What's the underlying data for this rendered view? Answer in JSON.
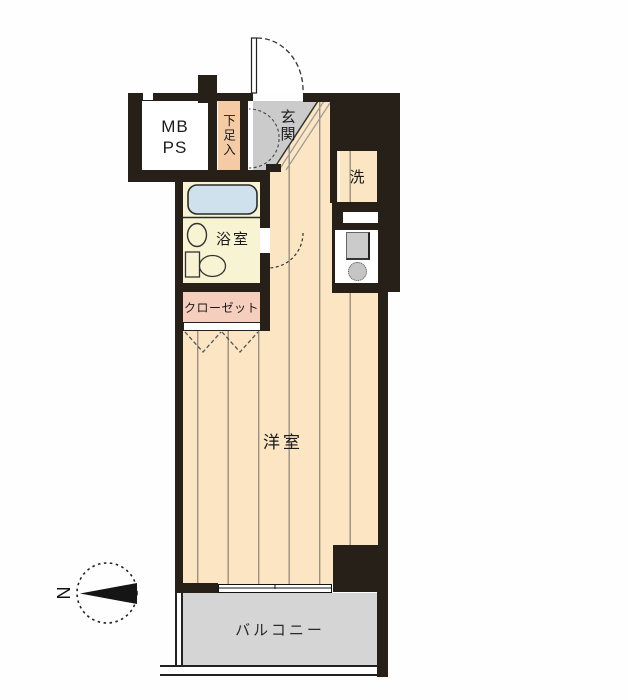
{
  "title": "apartment-floor-plan",
  "rooms": {
    "meter_pipe_space": "MB\nPS",
    "shoe_cabinet": "下足入",
    "entrance": "玄関",
    "laundry": "洗",
    "bathroom": "浴室",
    "closet": "クローゼット",
    "western_room": "洋室",
    "balcony": "バルコニー"
  },
  "compass": {
    "north": "N"
  },
  "colors": {
    "wall": "#272019",
    "flooring": "#fbe5c2",
    "flooring_line": "#9b9083",
    "bathroom": "#f8f4d3",
    "bathtub": "#cfe1ed",
    "closet": "#f6cebd",
    "shoe_cabinet": "#f5cba5",
    "entrance_floor": "#cbcbcb",
    "balcony": "#d5d5d5"
  }
}
